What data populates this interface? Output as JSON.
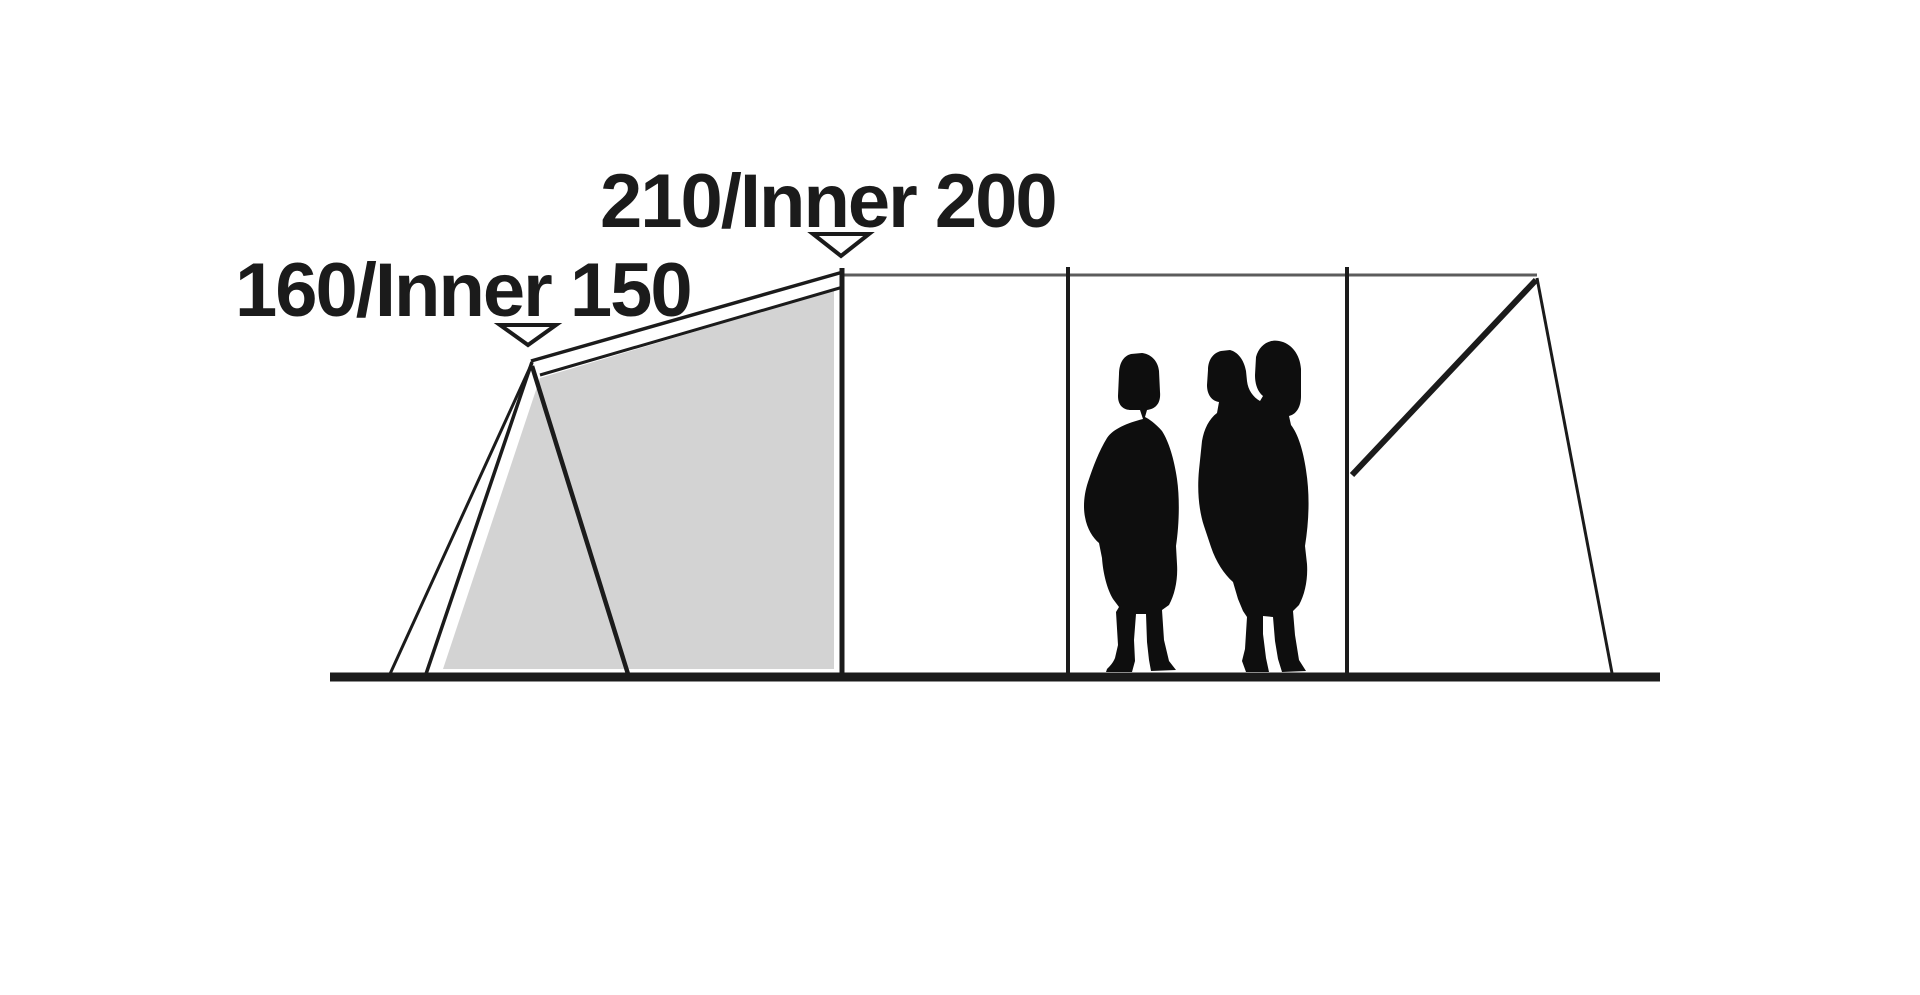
{
  "diagram": {
    "type": "tent-side-profile-dimensions",
    "labels": {
      "main_peak": "210/Inner 200",
      "side_peak": "160/Inner 150"
    },
    "icons": {
      "main_peak_marker": "triangle-down-marker",
      "side_peak_marker": "triangle-down-marker",
      "figures": "family-silhouette"
    },
    "colors": {
      "ink": "#1b1b1b",
      "ridge": "#5c5c5c",
      "inner_fill": "#d3d3d3",
      "silhouette": "#0e0e0e",
      "marker_fill": "#ffffff",
      "background": "#ffffff"
    }
  }
}
